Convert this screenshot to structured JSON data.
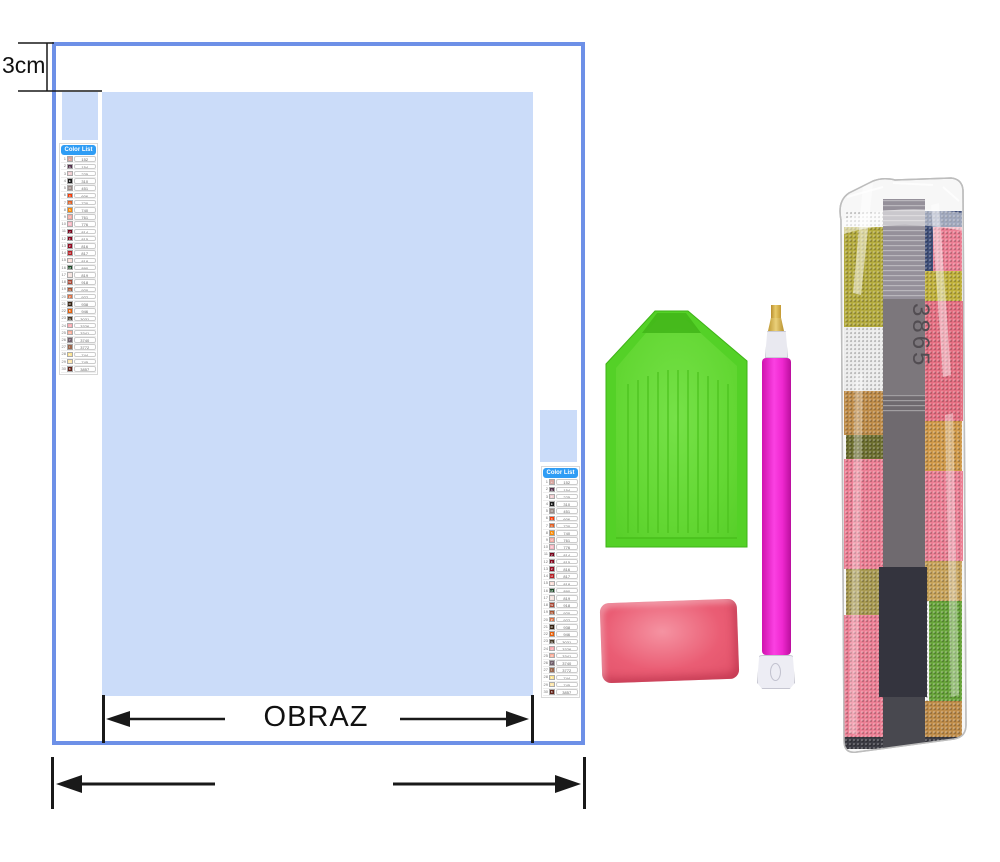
{
  "labels": {
    "top_margin": "3cm",
    "picture_width": "OBRAZ"
  },
  "color_list": {
    "header": "Color List",
    "rows": [
      {
        "n": 1,
        "sym": "+",
        "code": "152",
        "color": "#d9a6a0"
      },
      {
        "n": 2,
        "sym": "A",
        "code": "154",
        "color": "#53304b"
      },
      {
        "n": 3,
        "sym": "T",
        "code": "225",
        "color": "#f1cdd1"
      },
      {
        "n": 4,
        "sym": "E",
        "code": "310",
        "color": "#1a1a1a"
      },
      {
        "n": 5,
        "sym": "O",
        "code": "451",
        "color": "#988a86"
      },
      {
        "n": 6,
        "sym": "X",
        "code": "606",
        "color": "#f93a05"
      },
      {
        "n": 7,
        "sym": "C",
        "code": "720",
        "color": "#e25d20"
      },
      {
        "n": 8,
        "sym": "S",
        "code": "740",
        "color": "#f98a06"
      },
      {
        "n": 9,
        "sym": "U",
        "code": "761",
        "color": "#f3a9a3"
      },
      {
        "n": 10,
        "sym": "D",
        "code": "776",
        "color": "#f5b6c2"
      },
      {
        "n": 11,
        "sym": "V",
        "code": "814",
        "color": "#770019"
      },
      {
        "n": 12,
        "sym": "F",
        "code": "815",
        "color": "#84061e"
      },
      {
        "n": 13,
        "sym": "Z",
        "code": "816",
        "color": "#930a22"
      },
      {
        "n": 14,
        "sym": "H",
        "code": "817",
        "color": "#b71d24"
      },
      {
        "n": 15,
        "sym": "K",
        "code": "818",
        "color": "#fbdcd6"
      },
      {
        "n": 16,
        "sym": "M",
        "code": "890",
        "color": "#1b4a26"
      },
      {
        "n": 17,
        "sym": "L",
        "code": "819",
        "color": "#f6e4e0"
      },
      {
        "n": 18,
        "sym": "W",
        "code": "918",
        "color": "#a84431"
      },
      {
        "n": 19,
        "sym": "N",
        "code": "920",
        "color": "#a85331"
      },
      {
        "n": 20,
        "sym": "P",
        "code": "922",
        "color": "#dd7145"
      },
      {
        "n": 21,
        "sym": "R",
        "code": "938",
        "color": "#33200f"
      },
      {
        "n": 22,
        "sym": "B",
        "code": "946",
        "color": "#e65f08"
      },
      {
        "n": 23,
        "sym": "G",
        "code": "3031",
        "color": "#463a28"
      },
      {
        "n": 24,
        "sym": "J",
        "code": "3326",
        "color": "#f9aab1"
      },
      {
        "n": 25,
        "sym": "Q",
        "code": "3341",
        "color": "#faa995"
      },
      {
        "n": 26,
        "sym": "Y",
        "code": "3740",
        "color": "#72606c"
      },
      {
        "n": 27,
        "sym": "I",
        "code": "3772",
        "color": "#9c684e"
      },
      {
        "n": 28,
        "sym": "5",
        "code": "744",
        "color": "#fbe28f"
      },
      {
        "n": 29,
        "sym": "3",
        "code": "745",
        "color": "#fde5a8"
      },
      {
        "n": 30,
        "sym": "8",
        "code": "3857",
        "color": "#62241a"
      }
    ]
  },
  "bag": {
    "pack_number": "3865"
  },
  "colors": {
    "canvas_border": "#6d90e7",
    "print_area": "#cbdcf9",
    "header_bg": "#2f9df5",
    "tray_green": "#54d127",
    "tray_inner": "#67da36",
    "pen_pink": "#f32bd3",
    "pen_tip_gold": "#d9b845",
    "wax_pink": "#ea5d74",
    "dim_black": "#191919"
  }
}
